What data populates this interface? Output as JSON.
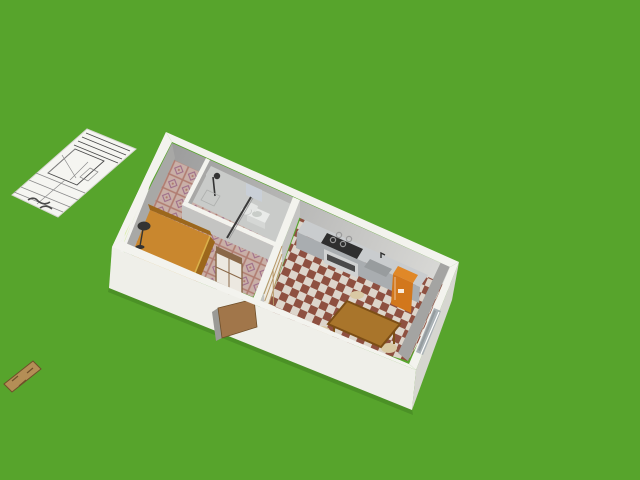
{
  "view": {
    "kind": "home-design-3d-viewport",
    "width_px": 640,
    "height_px": 480
  },
  "scene": {
    "ground": "grass-lawn",
    "items": [
      "blueprint-sheet-on-grass",
      "wooden-plank-on-grass",
      "apartment-model",
      "bedroom-with-bed-window-lamp-wardrobe",
      "bathroom-with-shower-sink-toilet-mirror",
      "kitchen-living-room-with-counter-stove-sink-fridge-table-chairs-sofa",
      "front-door-open",
      "sliding-glass-door-right-wall"
    ]
  },
  "colors": {
    "grass": "#57a42c",
    "grassShade": "#3f7a1e",
    "wallTop": "#f3f3ee",
    "wallOuterFront": "#efefe9",
    "wallOuterLeft": "#e3e3dd",
    "wallOuterRight": "#d6d6d0",
    "wallInnerDark": "#9c9c9c",
    "wallInnerLight": "#dadad7",
    "wallInnerSide": "#a8a8a6",
    "wallInnerEast": "#a4a4a2",
    "partitionFace": "#c4c4c2",
    "bathFloor": "#c9cbc9",
    "bathFixture": "#e9ebe9",
    "toilet": "#e4e6e4",
    "mirrorCabinet": "#c9cfd7",
    "showerDark": "#333333",
    "mirrorLine": "#3a3a3a",
    "bedroomTileBase": "#c9afa7",
    "bedroomTileLine": "#b07c70",
    "bedroomTileAccent": "#9c6a88",
    "kitchenTileA": "#8e5040",
    "kitchenTileB": "#ddd5cb",
    "counterTop": "#c9ccce",
    "counterFront": "#a9adb0",
    "stoveTop": "#2f2f2f",
    "burnerRing": "#9a9a9a",
    "ovenFront": "#d0d2d2",
    "ovenWindow": "#4a4a4a",
    "sinkBasin": "#989c9e",
    "fridge": "#e08828",
    "fridgeFront": "#d2771c",
    "tableTop": "#a9752b",
    "tableEdge": "#7c4e16",
    "chairSeat": "#d9c9a4",
    "sofa": "#3c5a47",
    "sofaDark": "#2c4936",
    "sofaLight": "#4a6a55",
    "bedTop": "#c9872e",
    "bedSide": "#9c671c",
    "bedFrame": "#d9b04a",
    "windowFrame": "#f2f2ee",
    "windowPane": "#d9edaa",
    "doorWood": "#a1764a",
    "doorEdge": "#9a9a96",
    "wardrobeFrame": "#8a6848",
    "wardrobePanel": "#ece8e0",
    "shojiPanel": "#edeadf",
    "shojiFrame": "#b89868",
    "glassDoorFrame": "#aab2b6",
    "glassDoorGlass": "#8b9396",
    "paper": "#f5f5f1",
    "paperEdge": "#d8d8d2",
    "ink": "#4a4a4a",
    "inkLight": "#8a8a8a",
    "plank": "#b48e56",
    "plankDark": "#6f4f2a"
  }
}
